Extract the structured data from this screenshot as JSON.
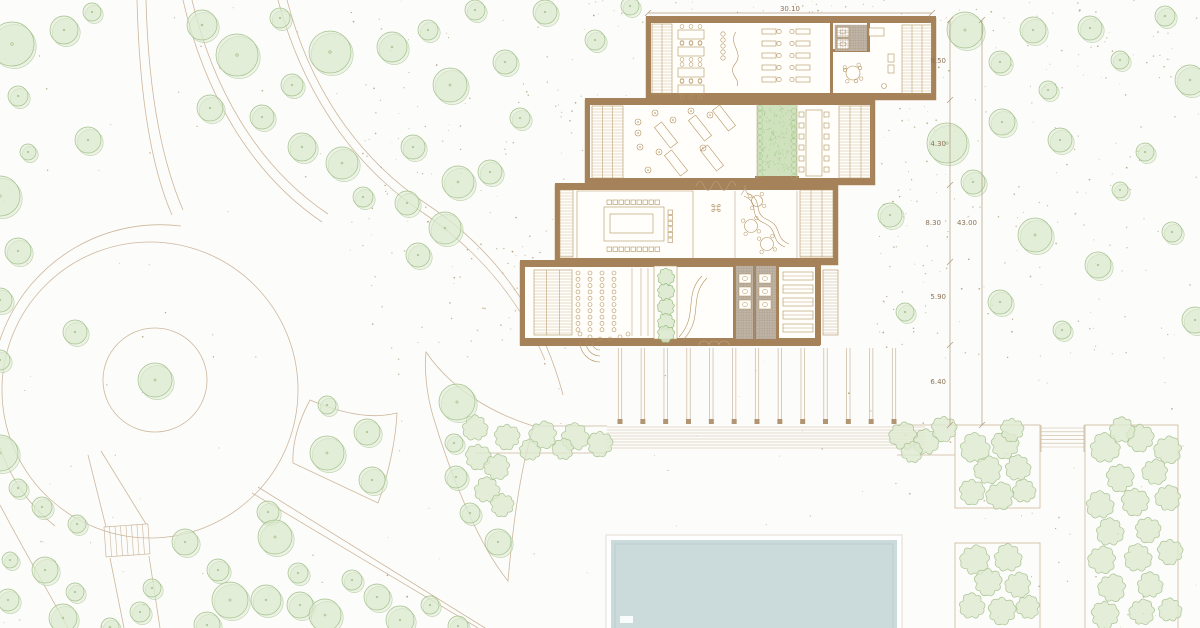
{
  "document": {
    "type": "architectural-site-plan",
    "description": "Landscape site plan with terraced pavilion building, circular plaza, tree field, planting beds and swimming pool"
  },
  "dimensions": {
    "top": "30.10",
    "right_segments": [
      "9.50",
      "4.30",
      "8.30",
      "5.90",
      "6.40"
    ],
    "right_total": "43.00"
  },
  "colors": {
    "background": "#fcfcfa",
    "tree_fill": "#dce9cf",
    "tree_stroke": "#a3c18b",
    "bush_fill": "#dde9d0",
    "bush_stroke": "#a9c392",
    "wall": "#a5825a",
    "line": "#cdb79d",
    "furniture": "#b3925f",
    "ground_dot": "#a2885f",
    "planting_fill": "#cfe2bd",
    "planting_stroke": "#8fb978",
    "pool_fill": "#cbdada",
    "pool_line": "#b5caca",
    "dim_text": "#8d7255",
    "dim_line": "#b49a7d",
    "tile": "#bfb4a6"
  },
  "trees": [
    [
      12,
      44,
      22
    ],
    [
      64,
      30,
      14
    ],
    [
      92,
      12,
      9
    ],
    [
      18,
      96,
      10
    ],
    [
      28,
      152,
      8
    ],
    [
      88,
      140,
      13
    ],
    [
      0,
      196,
      20
    ],
    [
      18,
      251,
      13
    ],
    [
      0,
      300,
      12
    ],
    [
      75,
      332,
      12
    ],
    [
      0,
      360,
      10
    ],
    [
      0,
      453,
      18
    ],
    [
      18,
      488,
      9
    ],
    [
      42,
      507,
      10
    ],
    [
      77,
      524,
      9
    ],
    [
      10,
      560,
      8
    ],
    [
      45,
      570,
      13
    ],
    [
      8,
      600,
      11
    ],
    [
      75,
      592,
      9
    ],
    [
      63,
      618,
      14
    ],
    [
      110,
      627,
      9
    ],
    [
      140,
      612,
      10
    ],
    [
      152,
      588,
      9
    ],
    [
      185,
      542,
      13
    ],
    [
      218,
      570,
      11
    ],
    [
      230,
      600,
      18
    ],
    [
      207,
      625,
      13
    ],
    [
      268,
      512,
      11
    ],
    [
      275,
      537,
      17
    ],
    [
      298,
      573,
      10
    ],
    [
      266,
      600,
      15
    ],
    [
      300,
      605,
      13
    ],
    [
      325,
      615,
      16
    ],
    [
      352,
      580,
      10
    ],
    [
      377,
      597,
      13
    ],
    [
      400,
      620,
      14
    ],
    [
      430,
      605,
      9
    ],
    [
      458,
      626,
      10
    ],
    [
      327,
      405,
      9
    ],
    [
      367,
      432,
      13
    ],
    [
      327,
      453,
      17
    ],
    [
      372,
      480,
      13
    ],
    [
      457,
      402,
      18
    ],
    [
      454,
      443,
      9
    ],
    [
      456,
      477,
      11
    ],
    [
      470,
      513,
      10
    ],
    [
      498,
      542,
      13
    ],
    [
      202,
      25,
      15
    ],
    [
      237,
      55,
      21
    ],
    [
      280,
      18,
      10
    ],
    [
      210,
      108,
      13
    ],
    [
      262,
      117,
      12
    ],
    [
      292,
      85,
      11
    ],
    [
      330,
      52,
      21
    ],
    [
      392,
      47,
      15
    ],
    [
      428,
      30,
      10
    ],
    [
      450,
      85,
      17
    ],
    [
      413,
      147,
      12
    ],
    [
      302,
      147,
      14
    ],
    [
      342,
      163,
      16
    ],
    [
      363,
      197,
      10
    ],
    [
      407,
      203,
      12
    ],
    [
      458,
      182,
      16
    ],
    [
      418,
      255,
      12
    ],
    [
      445,
      228,
      16
    ],
    [
      490,
      172,
      12
    ],
    [
      520,
      118,
      10
    ],
    [
      545,
      12,
      12
    ],
    [
      595,
      40,
      10
    ],
    [
      505,
      62,
      12
    ],
    [
      475,
      10,
      10
    ],
    [
      630,
      6,
      9
    ],
    [
      965,
      30,
      18
    ],
    [
      1000,
      62,
      11
    ],
    [
      1033,
      30,
      13
    ],
    [
      1090,
      28,
      12
    ],
    [
      1165,
      16,
      10
    ],
    [
      1120,
      60,
      9
    ],
    [
      1190,
      80,
      15
    ],
    [
      947,
      143,
      20
    ],
    [
      973,
      182,
      12
    ],
    [
      1002,
      122,
      13
    ],
    [
      1060,
      140,
      12
    ],
    [
      1145,
      152,
      9
    ],
    [
      1035,
      235,
      17
    ],
    [
      1098,
      265,
      13
    ],
    [
      1172,
      232,
      10
    ],
    [
      1195,
      320,
      13
    ],
    [
      1000,
      302,
      12
    ],
    [
      1062,
      330,
      9
    ],
    [
      890,
      215,
      12
    ],
    [
      905,
      312,
      9
    ],
    [
      1120,
      190,
      8
    ],
    [
      1048,
      90,
      9
    ],
    [
      155,
      380,
      17
    ]
  ],
  "bushes": [
    [
      475,
      428,
      12
    ],
    [
      507,
      437,
      12
    ],
    [
      543,
      435,
      13
    ],
    [
      575,
      437,
      13
    ],
    [
      600,
      444,
      12
    ],
    [
      563,
      449,
      10
    ],
    [
      530,
      450,
      10
    ],
    [
      478,
      457,
      12
    ],
    [
      497,
      467,
      12
    ],
    [
      487,
      490,
      12
    ],
    [
      502,
      505,
      11
    ],
    [
      903,
      436,
      13
    ],
    [
      926,
      442,
      12
    ],
    [
      944,
      429,
      12
    ],
    [
      912,
      452,
      10
    ],
    [
      975,
      448,
      14
    ],
    [
      1005,
      445,
      13
    ],
    [
      988,
      470,
      13
    ],
    [
      1018,
      468,
      12
    ],
    [
      972,
      492,
      12
    ],
    [
      1000,
      496,
      13
    ],
    [
      1024,
      491,
      11
    ],
    [
      1012,
      430,
      11
    ],
    [
      975,
      560,
      14
    ],
    [
      1008,
      558,
      13
    ],
    [
      988,
      582,
      13
    ],
    [
      1018,
      585,
      12
    ],
    [
      972,
      606,
      12
    ],
    [
      1002,
      611,
      13
    ],
    [
      1028,
      607,
      11
    ],
    [
      1105,
      448,
      14
    ],
    [
      1140,
      438,
      13
    ],
    [
      1168,
      450,
      13
    ],
    [
      1122,
      430,
      12
    ],
    [
      1120,
      478,
      13
    ],
    [
      1155,
      472,
      12
    ],
    [
      1100,
      505,
      13
    ],
    [
      1135,
      502,
      13
    ],
    [
      1168,
      498,
      12
    ],
    [
      1110,
      532,
      13
    ],
    [
      1148,
      530,
      12
    ],
    [
      1102,
      560,
      13
    ],
    [
      1138,
      558,
      13
    ],
    [
      1170,
      552,
      12
    ],
    [
      1112,
      588,
      13
    ],
    [
      1150,
      585,
      12
    ],
    [
      1105,
      615,
      13
    ],
    [
      1142,
      612,
      12
    ],
    [
      1170,
      610,
      11
    ]
  ],
  "plan": {
    "speckle_zones": [
      {
        "x": 350,
        "y": 0,
        "w": 300,
        "h": 350,
        "n": 210
      },
      {
        "x": 650,
        "y": 0,
        "w": 290,
        "h": 16,
        "n": 25
      },
      {
        "x": 876,
        "y": 20,
        "w": 64,
        "h": 330,
        "n": 70
      },
      {
        "x": 936,
        "y": 0,
        "w": 264,
        "h": 360,
        "n": 170
      },
      {
        "x": 0,
        "y": 0,
        "w": 350,
        "h": 628,
        "n": 60
      },
      {
        "x": 950,
        "y": 360,
        "w": 250,
        "h": 268,
        "n": 40
      },
      {
        "x": 350,
        "y": 350,
        "w": 600,
        "h": 278,
        "n": 45
      },
      {
        "x": 555,
        "y": 100,
        "w": 95,
        "h": 250,
        "n": 35
      }
    ],
    "speckle_exclusions": [
      [
        644,
        14,
        294,
        88
      ],
      [
        583,
        96,
        294,
        91
      ],
      [
        553,
        181,
        287,
        86
      ],
      [
        518,
        258,
        304,
        90
      ],
      [
        604,
        533,
        300,
        95
      ]
    ],
    "louvers": [
      {
        "x": 652,
        "y": 24,
        "w": 20,
        "h": 70,
        "cols": 2,
        "step": 3
      },
      {
        "x": 902,
        "y": 25,
        "w": 30,
        "h": 69,
        "cols": 3,
        "step": 3
      },
      {
        "x": 592,
        "y": 106,
        "w": 31,
        "h": 72,
        "cols": 3,
        "step": 3
      },
      {
        "x": 839,
        "y": 106,
        "w": 33,
        "h": 72,
        "cols": 3,
        "step": 3
      },
      {
        "x": 560,
        "y": 190,
        "w": 13,
        "h": 67,
        "cols": 1,
        "step": 3
      },
      {
        "x": 800,
        "y": 190,
        "w": 33,
        "h": 67,
        "cols": 3,
        "step": 3
      },
      {
        "x": 534,
        "y": 270,
        "w": 38,
        "h": 65,
        "cols": 3,
        "step": 3
      },
      {
        "x": 823,
        "y": 270,
        "w": 15,
        "h": 65,
        "cols": 1,
        "step": 3
      }
    ],
    "tile_grids": [
      {
        "x": 736,
        "y": 266,
        "w": 40,
        "h": 73,
        "step": 2.6
      },
      {
        "x": 835,
        "y": 25,
        "w": 32,
        "h": 26,
        "step": 2.6
      }
    ],
    "pergola": {
      "x0": 620,
      "x1": 894,
      "count": 13,
      "y_top": 348,
      "y_bot": 419,
      "gap": 3.4
    },
    "deck": {
      "x0": 607,
      "x1": 925,
      "y0": 427,
      "rows": 8,
      "step": 3
    },
    "east_steps": {
      "x0": 1041,
      "x1": 1084,
      "y0": 428,
      "rows": 6,
      "step": 3.8
    },
    "stairs": [
      {
        "x": 104,
        "y": 527,
        "w": 44,
        "h": 30,
        "rungs": 8
      },
      {
        "x": 522,
        "y": 305,
        "w": 9,
        "h": 24,
        "rungs": 6
      }
    ],
    "auditorium": {
      "cols": [
        578,
        590,
        602,
        614
      ],
      "y0": 273,
      "step": 6.3,
      "rows": 10,
      "arc": [
        [
          580,
          334
        ],
        [
          590,
          337
        ],
        [
          600,
          339
        ],
        [
          610,
          339
        ],
        [
          620,
          337
        ],
        [
          628,
          334
        ]
      ]
    },
    "conference": {
      "size": 4.5,
      "top": {
        "x0": 607,
        "y": 200,
        "count": 9,
        "step": 6
      },
      "bottom": {
        "x0": 607,
        "y": 247,
        "count": 9,
        "step": 6
      },
      "right": {
        "x": 668,
        "y0": 210,
        "count": 6,
        "step": 5.6
      }
    },
    "long_table": {
      "cols": [
        799,
        824
      ],
      "y0": 112,
      "step": 11,
      "count": 6,
      "size": 5
    },
    "sauna": {
      "x": 783,
      "y0": 272,
      "step": 13,
      "count": 5,
      "w": 30,
      "h": 8
    },
    "wc_lower": {
      "cols": [
        739,
        759
      ],
      "ys": [
        274,
        287,
        300
      ],
      "w": 12,
      "h": 9
    },
    "wc_upper": {
      "x": 837,
      "ys": [
        27,
        39
      ],
      "w": 12,
      "h": 10
    },
    "workstations": {
      "cols": [
        {
          "x": 762,
          "chair_dx": 17
        },
        {
          "x": 796,
          "chair_dx": -4
        }
      ],
      "rows": [
        29,
        41,
        53,
        65,
        77
      ],
      "w": 14,
      "h": 5
    },
    "office_tables": [
      [
        678,
        30
      ],
      [
        678,
        47
      ],
      [
        678,
        68
      ],
      [
        678,
        85
      ]
    ],
    "lounge_chairs": [
      [
        638,
        122
      ],
      [
        655,
        113
      ],
      [
        673,
        120
      ],
      [
        691,
        111
      ],
      [
        640,
        147
      ],
      [
        659,
        152
      ],
      [
        648,
        170
      ],
      [
        703,
        148
      ],
      [
        638,
        133
      ],
      [
        710,
        115
      ]
    ],
    "loungers": [
      [
        666,
        135
      ],
      [
        700,
        128
      ],
      [
        724,
        118
      ],
      [
        676,
        163
      ],
      [
        712,
        158
      ]
    ],
    "round_tables": [
      [
        751,
        226,
        6.5
      ],
      [
        767,
        244,
        6.5
      ],
      [
        757,
        201,
        5.5
      ],
      [
        853,
        73,
        7
      ]
    ],
    "courtyard": {
      "x": 757,
      "y": 104,
      "w": 40,
      "h": 74,
      "hatch": 130
    },
    "planter": {
      "x": 666,
      "ys": [
        277,
        292,
        307,
        322,
        334
      ],
      "r": 8
    },
    "dim": {
      "top_line": {
        "x1": 648,
        "x2": 932,
        "y": 13
      },
      "v_lines": [
        {
          "x": 950,
          "y1": 20,
          "y2": 425,
          "ticks": [
            20,
            100,
            185,
            262,
            345,
            425
          ]
        },
        {
          "x": 982,
          "y1": 20,
          "y2": 425,
          "ticks": [
            20,
            425
          ]
        }
      ],
      "segment_label_pos": [
        [
          946,
          63
        ],
        [
          946,
          146
        ],
        [
          941,
          225
        ],
        [
          946,
          299
        ],
        [
          946,
          384
        ]
      ],
      "total_label_pos": [
        977,
        225
      ]
    }
  }
}
